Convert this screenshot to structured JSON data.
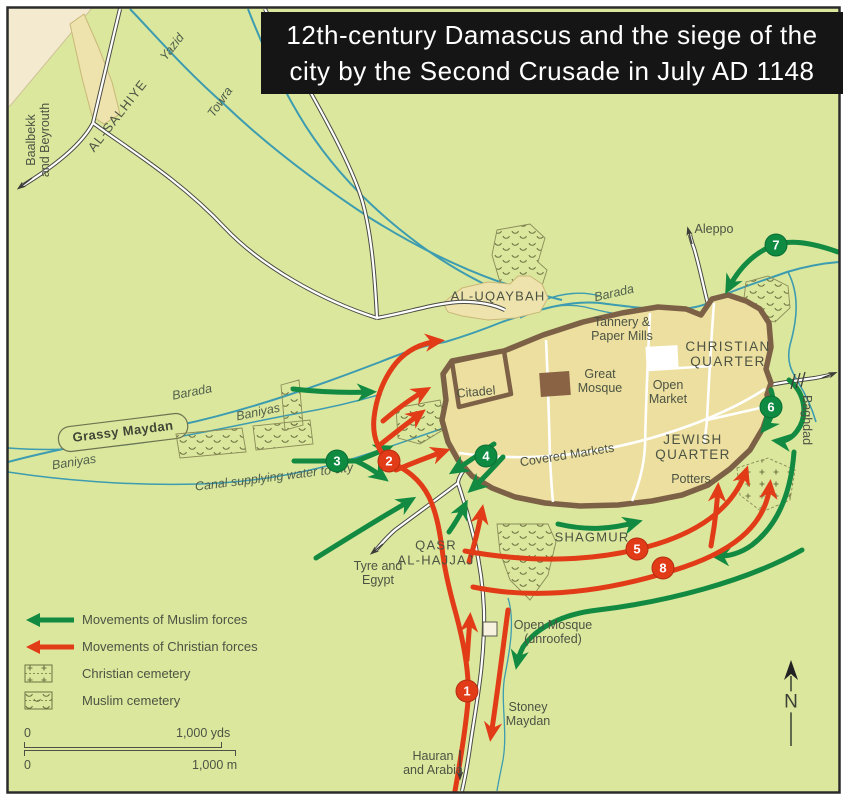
{
  "title": {
    "line1": "12th-century Damascus and the siege of the",
    "line2": "city by the Second Crusade in July AD 1148"
  },
  "legend": {
    "items": [
      {
        "icon": "muslim-arrow-icon",
        "label": "Movements of Muslim forces"
      },
      {
        "icon": "christian-arrow-icon",
        "label": "Movements of Christian forces"
      },
      {
        "icon": "christian-cemetery-icon",
        "label": "Christian cemetery"
      },
      {
        "icon": "muslim-cemetery-icon",
        "label": "Muslim cemetery"
      }
    ]
  },
  "scale": {
    "yds": {
      "left": "0",
      "right": "1,000 yds"
    },
    "m": {
      "left": "0",
      "right": "1,000 m"
    }
  },
  "compass": {
    "label": "N"
  },
  "colors": {
    "background": "#dbe79d",
    "terrain_corner": "#f3ead0",
    "suburb_fill": "#eee3ad",
    "city_fill": "#ecdf9f",
    "wall_brown": "#7d6146",
    "river_teal": "#3d9cb0",
    "muslim_green": "#128a41",
    "christian_red": "#e23b17",
    "label_olive": "#4c5343",
    "title_bg": "#151515",
    "title_text": "#ffffff"
  },
  "markers": [
    {
      "label": "1",
      "type": "red",
      "x": 467,
      "y": 691
    },
    {
      "label": "2",
      "type": "red",
      "x": 389,
      "y": 461
    },
    {
      "label": "3",
      "type": "green",
      "x": 337,
      "y": 461
    },
    {
      "label": "4",
      "type": "green",
      "x": 486,
      "y": 456
    },
    {
      "label": "5",
      "type": "red",
      "x": 637,
      "y": 549
    },
    {
      "label": "6",
      "type": "green",
      "x": 771,
      "y": 407
    },
    {
      "label": "7",
      "type": "green",
      "x": 776,
      "y": 245
    },
    {
      "label": "8",
      "type": "red",
      "x": 663,
      "y": 568
    }
  ],
  "labels": [
    {
      "id": "al-salhiye",
      "text": "AL-SALHIYE",
      "x": 118,
      "y": 116,
      "rot": -52,
      "cls": "caps"
    },
    {
      "id": "yazid-river",
      "text": "Yazid",
      "x": 172,
      "y": 47,
      "rot": -52,
      "cls": "river"
    },
    {
      "id": "towra-river",
      "text": "Towra",
      "x": 220,
      "y": 102,
      "rot": -55,
      "cls": "river"
    },
    {
      "id": "baalbekk-road",
      "text": "Baalbekk\nand Beyrouth",
      "x": 38,
      "y": 140,
      "rot": -90,
      "cls": ""
    },
    {
      "id": "al-uqaybah",
      "text": "AL-UQAYBAH",
      "x": 498,
      "y": 297,
      "rot": 0,
      "cls": "caps"
    },
    {
      "id": "barada-west",
      "text": "Barada",
      "x": 192,
      "y": 392,
      "rot": -11,
      "cls": "river"
    },
    {
      "id": "barada-north",
      "text": "Barada",
      "x": 614,
      "y": 293,
      "rot": -13,
      "cls": "river"
    },
    {
      "id": "baniyas-upper",
      "text": "Baniyas",
      "x": 258,
      "y": 412,
      "rot": -12,
      "cls": "river"
    },
    {
      "id": "baniyas-lower",
      "text": "Baniyas",
      "x": 74,
      "y": 462,
      "rot": -9,
      "cls": "river"
    },
    {
      "id": "canal-label",
      "text": "Canal supplying water to city",
      "x": 274,
      "y": 477,
      "rot": -7,
      "cls": "river"
    },
    {
      "id": "grassy-maydan",
      "text": "Grassy Maydan",
      "x": 123,
      "y": 432,
      "rot": -7,
      "cls": "strong"
    },
    {
      "id": "citadel",
      "text": "Citadel",
      "x": 476,
      "y": 392,
      "rot": -5,
      "cls": ""
    },
    {
      "id": "great-mosque",
      "text": "Great\nMosque",
      "x": 600,
      "y": 381,
      "rot": 0,
      "cls": ""
    },
    {
      "id": "open-market",
      "text": "Open\nMarket",
      "x": 668,
      "y": 392,
      "rot": 0,
      "cls": ""
    },
    {
      "id": "christian-quarter",
      "text": "CHRISTIAN\nQUARTER",
      "x": 728,
      "y": 354,
      "rot": 0,
      "cls": "quarter"
    },
    {
      "id": "jewish-quarter",
      "text": "JEWISH\nQUARTER",
      "x": 693,
      "y": 447,
      "rot": 0,
      "cls": "quarter"
    },
    {
      "id": "covered-markets",
      "text": "Covered Markets",
      "x": 567,
      "y": 455,
      "rot": -9,
      "cls": ""
    },
    {
      "id": "potters",
      "text": "Potters",
      "x": 691,
      "y": 479,
      "rot": 0,
      "cls": ""
    },
    {
      "id": "tannery",
      "text": "Tannery &\nPaper Mills",
      "x": 622,
      "y": 329,
      "rot": 0,
      "cls": ""
    },
    {
      "id": "shagmur",
      "text": "SHAGMUR",
      "x": 592,
      "y": 538,
      "rot": 0,
      "cls": "caps"
    },
    {
      "id": "qasr-al-hajjaj",
      "text": "QASR\nAL-HAJJAJ",
      "x": 436,
      "y": 553,
      "rot": 0,
      "cls": "caps"
    },
    {
      "id": "tyre-egypt",
      "text": "Tyre and\nEgypt",
      "x": 378,
      "y": 573,
      "rot": 0,
      "cls": ""
    },
    {
      "id": "open-mosque",
      "text": "Open Mosque\n(unroofed)",
      "x": 553,
      "y": 632,
      "rot": 0,
      "cls": ""
    },
    {
      "id": "stoney-maydan",
      "text": "Stoney\nMaydan",
      "x": 528,
      "y": 714,
      "rot": 0,
      "cls": ""
    },
    {
      "id": "hauran-arabia",
      "text": "Hauran\nand Arabia",
      "x": 433,
      "y": 763,
      "rot": 0,
      "cls": ""
    },
    {
      "id": "aleppo",
      "text": "Aleppo",
      "x": 714,
      "y": 229,
      "rot": 0,
      "cls": ""
    },
    {
      "id": "baghdad",
      "text": "Baghdad",
      "x": 807,
      "y": 420,
      "rot": 90,
      "cls": ""
    }
  ]
}
